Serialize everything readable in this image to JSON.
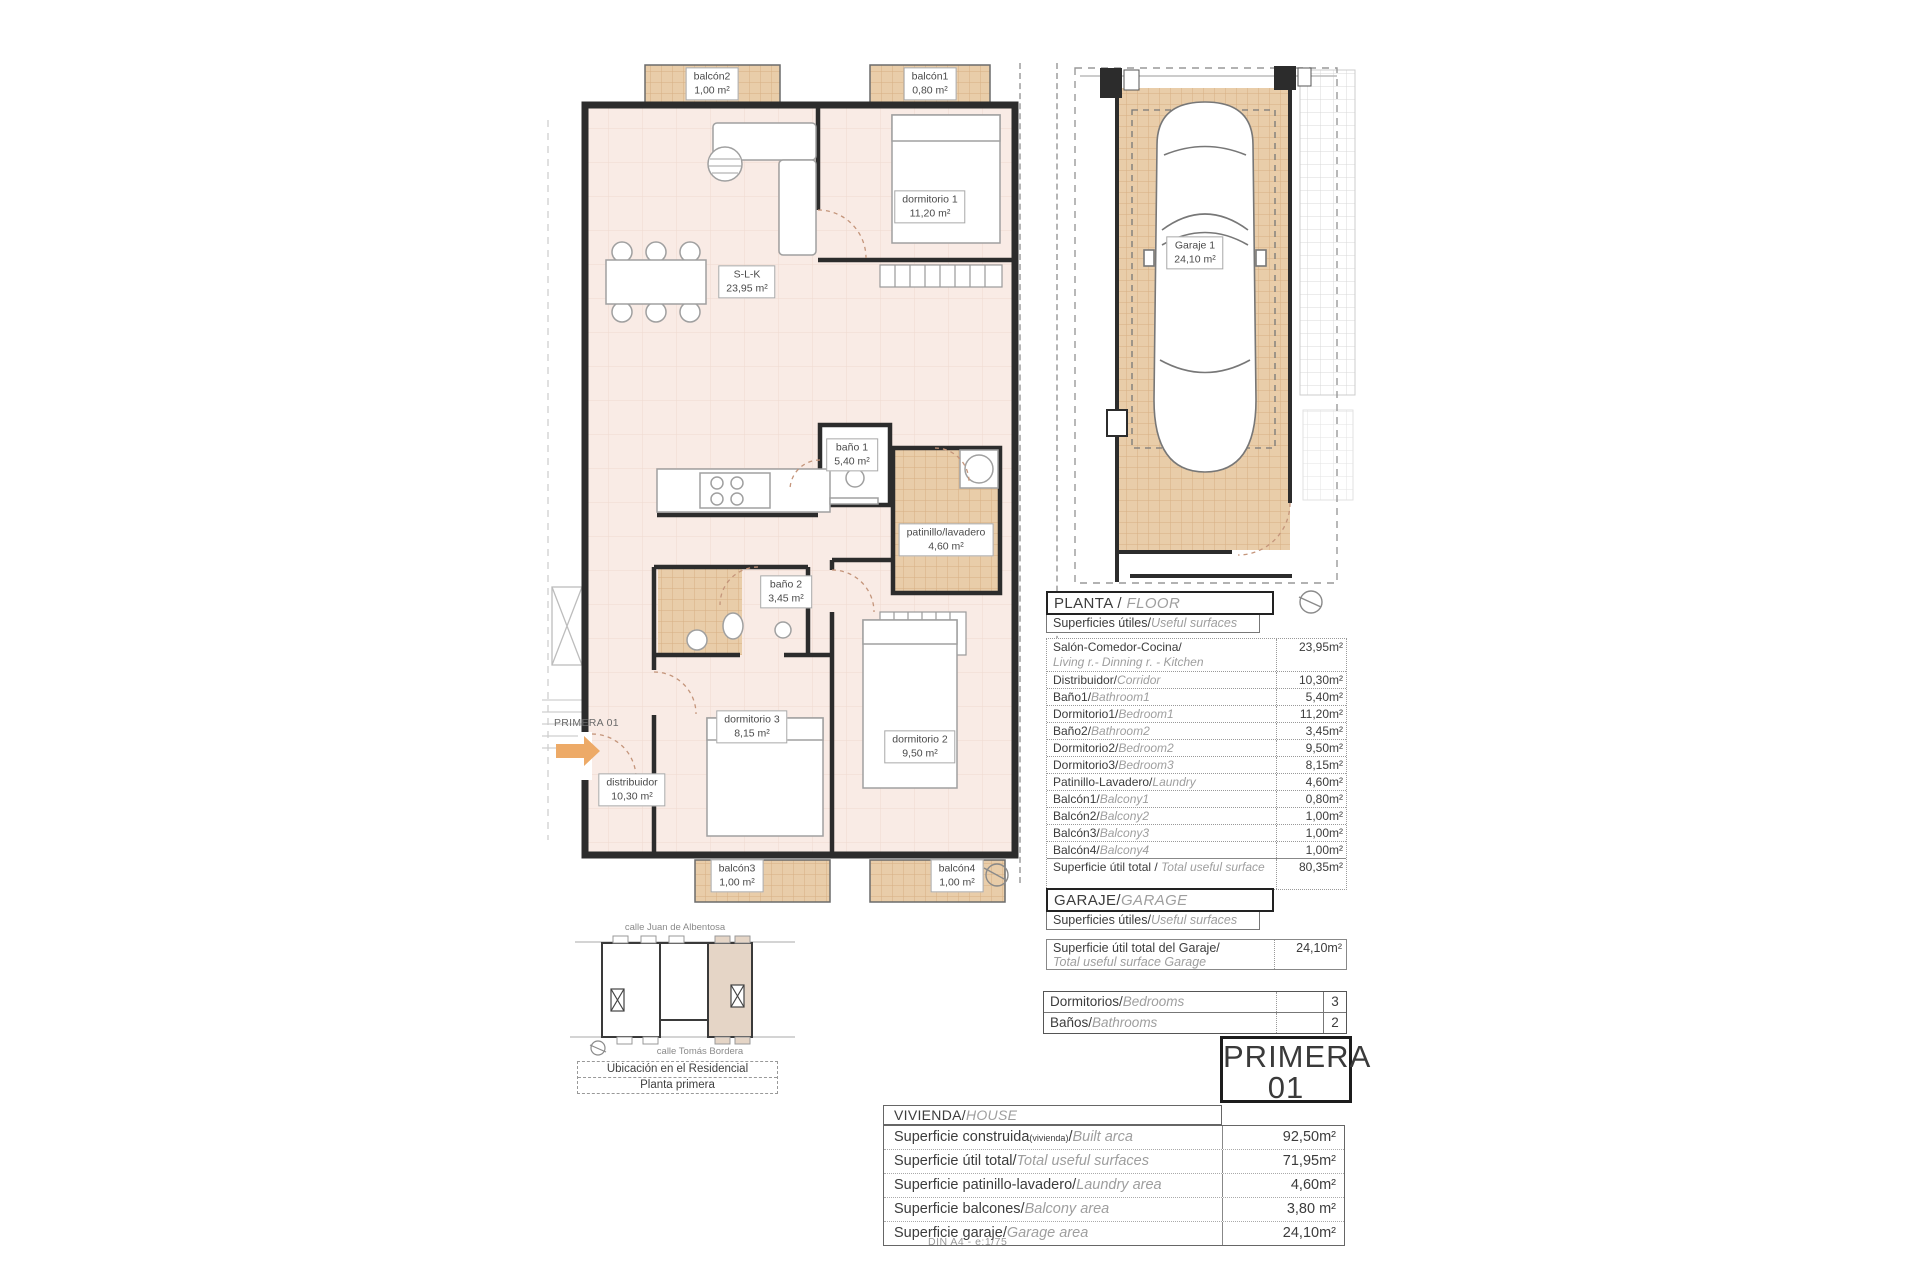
{
  "page": {
    "footer": "DIN A4 - e:1/75"
  },
  "colors": {
    "floor_pink": "#f9ebe5",
    "tile_tan": "#e9cda9",
    "wall_dark": "#2c2c2c",
    "highlight_beige": "#e5d5c6",
    "arrow_orange": "#edaa67"
  },
  "floor_plan": {
    "unit_text": "PRIMERA 01",
    "rooms": {
      "balcon2": {
        "name": "balcón2",
        "area": "1,00 m²"
      },
      "balcon1": {
        "name": "balcón1",
        "area": "0,80 m²"
      },
      "dormitorio1": {
        "name": "dormitorio 1",
        "area": "11,20 m²"
      },
      "slk": {
        "name": "S-L-K",
        "area": "23,95 m²"
      },
      "bano1": {
        "name": "baño 1",
        "area": "5,40 m²"
      },
      "patinillo": {
        "name": "patinillo/lavadero",
        "area": "4,60 m²"
      },
      "bano2": {
        "name": "baño 2",
        "area": "3,45 m²"
      },
      "dormitorio3": {
        "name": "dormitorio 3",
        "area": "8,15 m²"
      },
      "dormitorio2": {
        "name": "dormitorio 2",
        "area": "9,50 m²"
      },
      "distribuidor": {
        "name": "distribuidor",
        "area": "10,30 m²"
      },
      "balcon3": {
        "name": "balcón3",
        "area": "1,00 m²"
      },
      "balcon4": {
        "name": "balcón4",
        "area": "1,00 m²"
      }
    }
  },
  "garage_plan": {
    "room": {
      "name": "Garaje 1",
      "area": "24,10 m²"
    }
  },
  "planta_table": {
    "title_es": "PLANTA / ",
    "title_en": "FLOOR",
    "subtitle_es": "Superficies útiles/",
    "subtitle_en": "Useful surfaces",
    "rows": [
      {
        "es": "Salón-Comedor-Cocina/",
        "en": "Living r.- Dinning r. - Kitchen",
        "value": "23,95m²"
      },
      {
        "es": "Distribuidor/",
        "en": "Corridor",
        "value": "10,30m²"
      },
      {
        "es": "Baño1/",
        "en": "Bathroom1",
        "value": "5,40m²"
      },
      {
        "es": "Dormitorio1/",
        "en": "Bedroom1",
        "value": "11,20m²"
      },
      {
        "es": "Baño2/",
        "en": "Bathroom2",
        "value": "3,45m²"
      },
      {
        "es": "Dormitorio2/",
        "en": "Bedroom2",
        "value": "9,50m²"
      },
      {
        "es": "Dormitorio3/",
        "en": "Bedroom3",
        "value": "8,15m²"
      },
      {
        "es": "Patinillo-Lavadero/",
        "en": "Laundry",
        "value": "4,60m²"
      },
      {
        "es": "Balcón1/",
        "en": "Balcony1",
        "value": "0,80m²"
      },
      {
        "es": "Balcón2/",
        "en": "Balcony2",
        "value": "1,00m²"
      },
      {
        "es": "Balcón3/",
        "en": "Balcony3",
        "value": "1,00m²"
      },
      {
        "es": "Balcón4/",
        "en": "Balcony4",
        "value": "1,00m²"
      }
    ],
    "total": {
      "es": "Superficie útil total / ",
      "en": "Total useful surface",
      "value": "80,35m²"
    }
  },
  "garaje_table": {
    "title_es": "GARAJE/",
    "title_en": "GARAGE",
    "subtitle_es": "Superficies útiles/",
    "subtitle_en": "Useful surfaces",
    "row": {
      "es": "Superficie útil total del Garaje/",
      "en": "Total useful surface Garage",
      "value": "24,10m²"
    }
  },
  "counts": {
    "rows": [
      {
        "es": "Dormitorios/",
        "en": "Bedrooms",
        "value": "3"
      },
      {
        "es": "Baños/",
        "en": "Bathrooms",
        "value": "2"
      }
    ]
  },
  "unit_badge": {
    "line1": "PRIMERA",
    "line2": "01"
  },
  "vivienda_table": {
    "title_es": "VIVIENDA/",
    "title_en": "HOUSE",
    "rows": [
      {
        "es": "Superficie construida",
        "sub": "(vivienda)",
        "slash": "/",
        "en": "Built arca",
        "value": "92,50m²"
      },
      {
        "es": "Superficie útil total/",
        "en": "Total useful surfaces",
        "value": "71,95m²"
      },
      {
        "es": "Superficie patinillo-lavadero/",
        "en": "Laundry area",
        "value": "4,60m²"
      },
      {
        "es": "Superficie balcones/",
        "en": "Balcony area",
        "value": "3,80 m²"
      },
      {
        "es": "Superficie garaje/",
        "en": "Garage area",
        "value": "24,10m²"
      }
    ]
  },
  "location_map": {
    "street_top": "calle Juan de Albentosa",
    "street_bottom": "calle Tomás Bordera",
    "caption_line1": "Ubicación en el Residencial",
    "caption_line2": "Planta primera"
  }
}
